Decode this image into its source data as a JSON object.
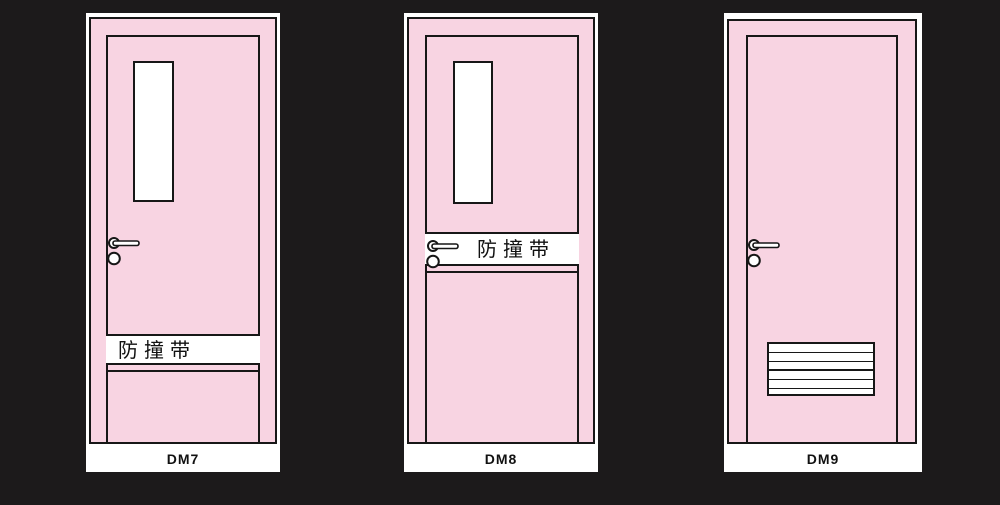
{
  "colors": {
    "background": "#1c1a1b",
    "door_pink": "#f8d4e2",
    "outline": "#171717",
    "panel_white": "#ffffff",
    "text": "#111111"
  },
  "doors": [
    {
      "label": "DM7",
      "band_label": "防撞带",
      "features": [
        "vision-window",
        "lever-handle",
        "lock-knob",
        "anti-collision-band"
      ]
    },
    {
      "label": "DM8",
      "band_label": "防撞带",
      "features": [
        "vision-window",
        "lever-handle",
        "lock-knob",
        "anti-collision-band"
      ]
    },
    {
      "label": "DM9",
      "features": [
        "lever-handle",
        "lock-knob",
        "vent-louver"
      ]
    }
  ]
}
